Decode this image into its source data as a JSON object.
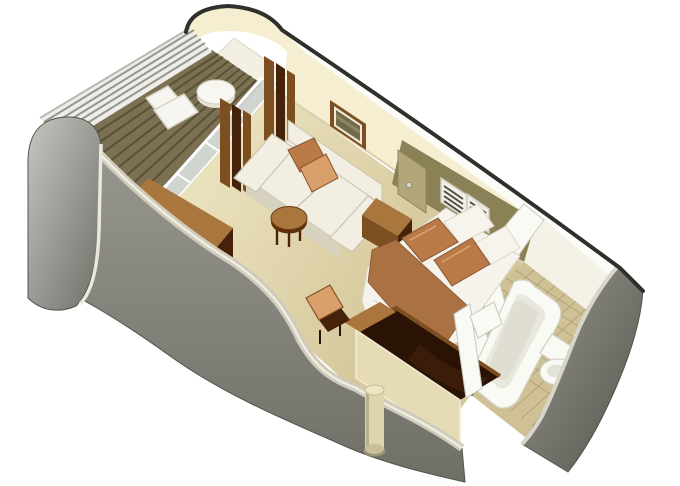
{
  "scene": {
    "type": "isometric-cutaway-cabin-floor-plan",
    "rooms": [
      {
        "name": "balcony",
        "items": [
          "teak-deck",
          "railing",
          "lounge-chair",
          "side-table"
        ]
      },
      {
        "name": "living-area",
        "items": [
          "sliding-glass-door",
          "curtains",
          "sofa",
          "throw-pillows",
          "coffee-table",
          "framed-picture",
          "wardrobe-cabinet"
        ]
      },
      {
        "name": "bedroom",
        "items": [
          "double-bed",
          "bed-pillows",
          "bed-runner",
          "nightstand",
          "headboard-wall",
          "louvered-panels",
          "interior-door",
          "desk-unit",
          "desk-chair",
          "structural-column"
        ]
      },
      {
        "name": "bathroom",
        "items": [
          "bathtub",
          "toilet",
          "washbasin",
          "tiled-floor",
          "entrance-door",
          "entry-partition"
        ]
      }
    ]
  },
  "colors": {
    "outline": "#2f2f2b",
    "wall_cream": "#f6eed1",
    "wall_cream_shade": "#ecdfba",
    "wall_top": "#fbfbf7",
    "gray_light": "#c6c6c1",
    "gray_mid": "#97978f",
    "gray_dark": "#6f6f68",
    "gray_deep": "#55554e",
    "carpet": "#e9e0bc",
    "carpet_dark": "#d5c79a",
    "deck": "#7b7152",
    "deck_line": "#585137",
    "tile": "#cfc195",
    "tile_line": "#b1a477",
    "olive": "#8b8156",
    "olive_dark": "#6e6543",
    "tan_door": "#b2a77b",
    "wood_light": "#a9763e",
    "wood_mid": "#7d4e20",
    "wood_dark": "#46220b",
    "wood_deep": "#2a1305",
    "copper": "#b97a48",
    "copper_light": "#d9a06b",
    "copper_dark": "#85501f",
    "cushion": "#f2efe2",
    "cushion_shade": "#d7d2bf",
    "white_fix": "#fafaf5",
    "white_shade": "#e2e2d8",
    "glass": "#ccd4d2",
    "art": "#6f6b4a"
  }
}
